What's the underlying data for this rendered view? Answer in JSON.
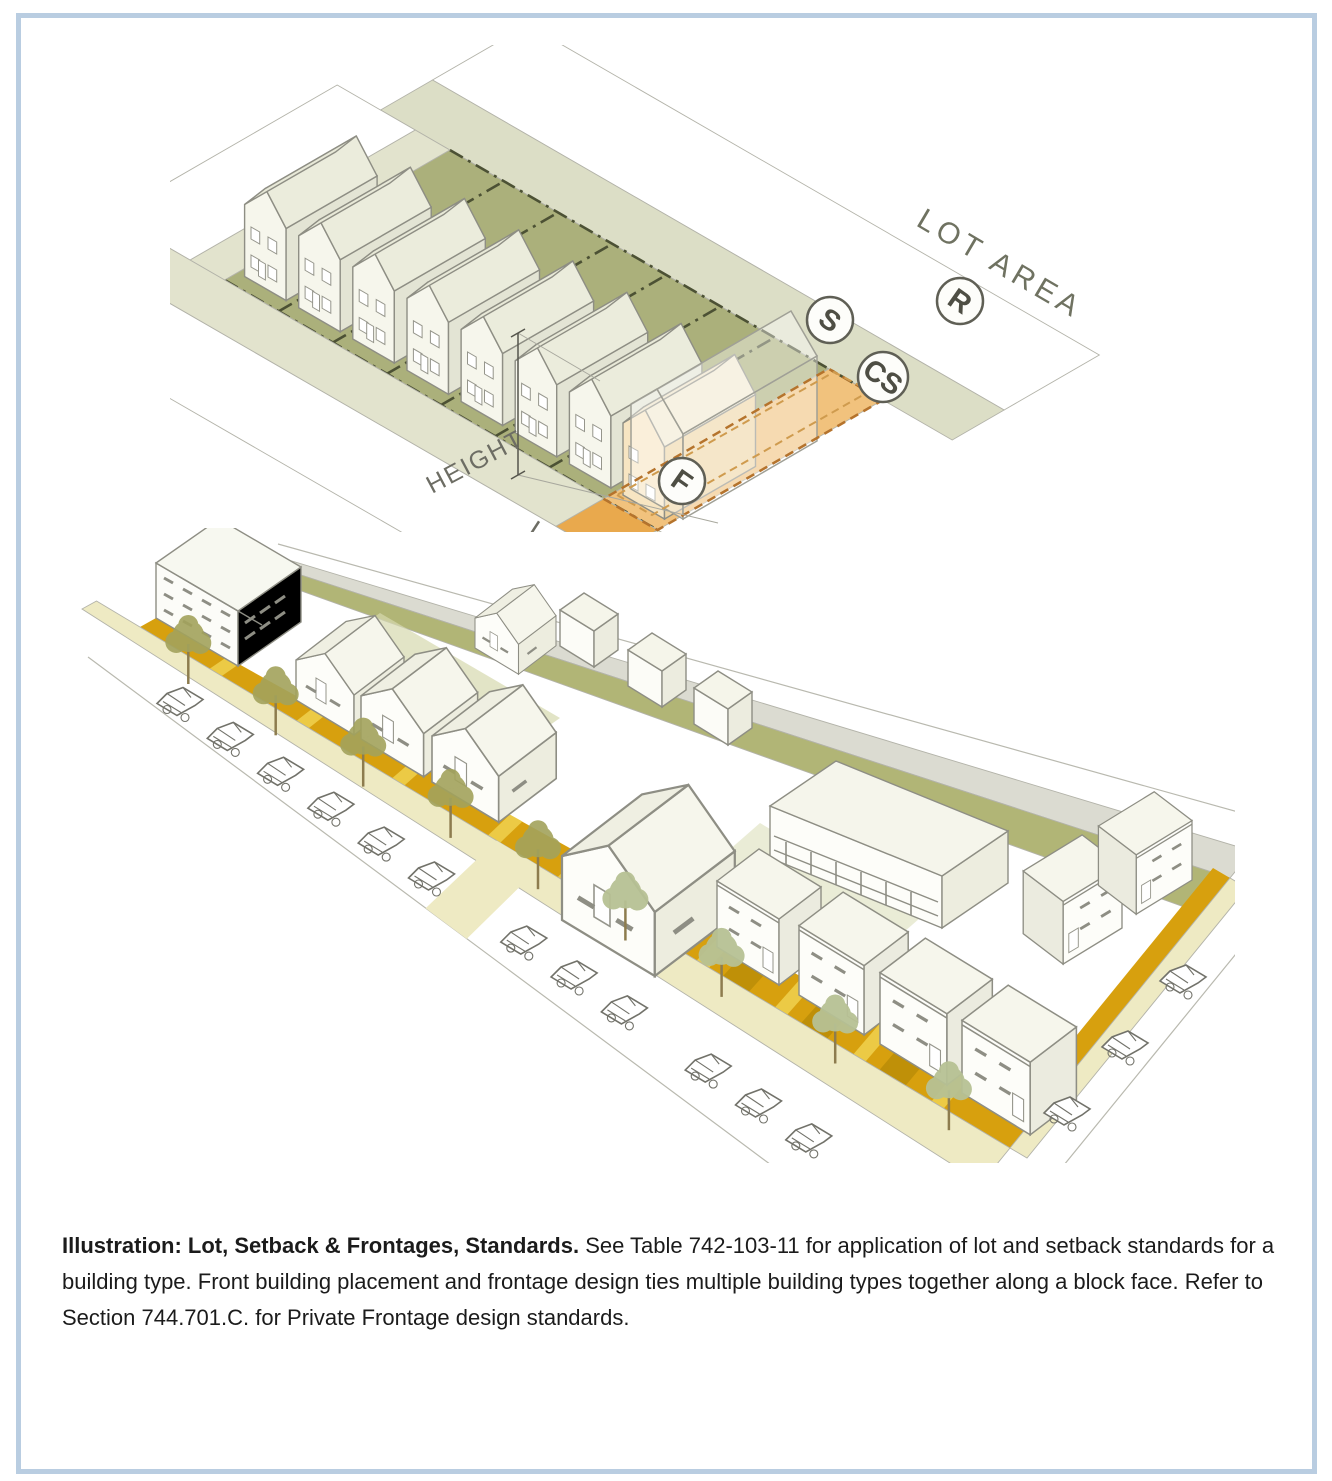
{
  "page": {
    "background": "#ffffff",
    "border_color": "#b9cde1"
  },
  "caption": {
    "lead_bold": "Illustration: Lot, Setback & Frontages, Standards.",
    "body": " See Table 742-103-11 for application of lot and setback standards for a building type. Front building placement and frontage design ties multiple building types together along a block face. Refer to Section 744.701.C. for Private Frontage design standards."
  },
  "top_diagram": {
    "labels": {
      "lot_area": "LOT AREA",
      "height": "HEIGHT",
      "lot_width_partial": "LO"
    },
    "badges": {
      "s": "S",
      "r": "R",
      "cs": "CS",
      "f": "F"
    },
    "colors": {
      "lot_green": "#abb07b",
      "lot_orange": "#f1c27d",
      "sidewalk": "#e2e3cd",
      "back_band": "#dcdec6",
      "orange_walk": "#e9a94d",
      "lot_line": "#4c5134",
      "orange_dash": "#b5732c"
    }
  },
  "bottom_diagram": {
    "colors": {
      "frontage_amber": "#d7a00e",
      "walkway_yellow": "#ecca45",
      "walkway_dark": "#bc8e08",
      "sidewalk_cream": "#eeeac3",
      "rear_lawn_olive": "#b1b576",
      "alley_gray": "#dbdbd1",
      "court_sage": "#d6d9ae",
      "tree_olive": "#a3a35c",
      "tree_sage": "#b7c194",
      "line_gray": "#8e8e84"
    }
  }
}
